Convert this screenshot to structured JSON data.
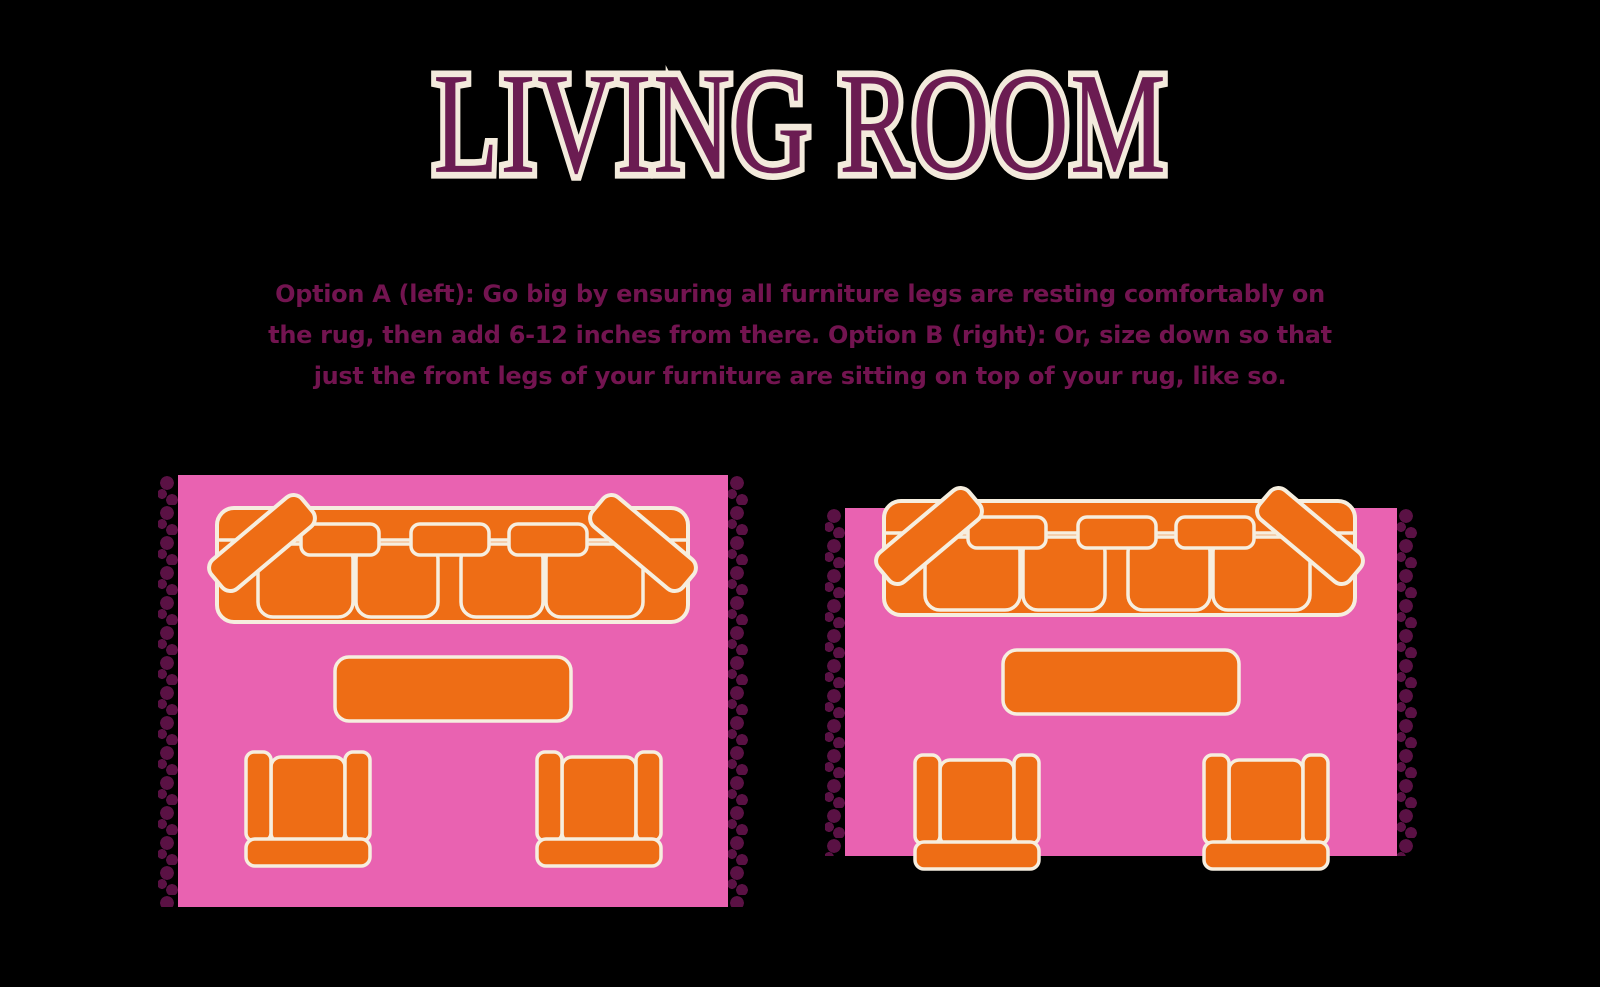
{
  "title": {
    "text": "LIVING ROOM"
  },
  "description": {
    "lines": [
      "Option A (left): Go big by ensuring all furniture legs are resting comfortably on",
      "the rug, then add 6-12 inches from there. Option B (right): Or, size down so that",
      "just the front legs of your furniture are sitting on top of your rug, like so."
    ]
  },
  "colors": {
    "page_bg": "#000000",
    "title_purple": "#6B1C52",
    "title_outline": "#F3EADC",
    "text_plum": "#731450",
    "rug_pink": "#E962B1",
    "fringe_plum": "#5A1144",
    "furniture_orange": "#EE6D15",
    "furniture_outline": "#F6EEDF"
  },
  "diagrams": [
    {
      "id": "option-a",
      "furniture": [
        "sofa",
        "coffee-table",
        "armchair",
        "armchair"
      ]
    },
    {
      "id": "option-b",
      "furniture": [
        "sofa",
        "coffee-table",
        "armchair",
        "armchair"
      ]
    }
  ]
}
